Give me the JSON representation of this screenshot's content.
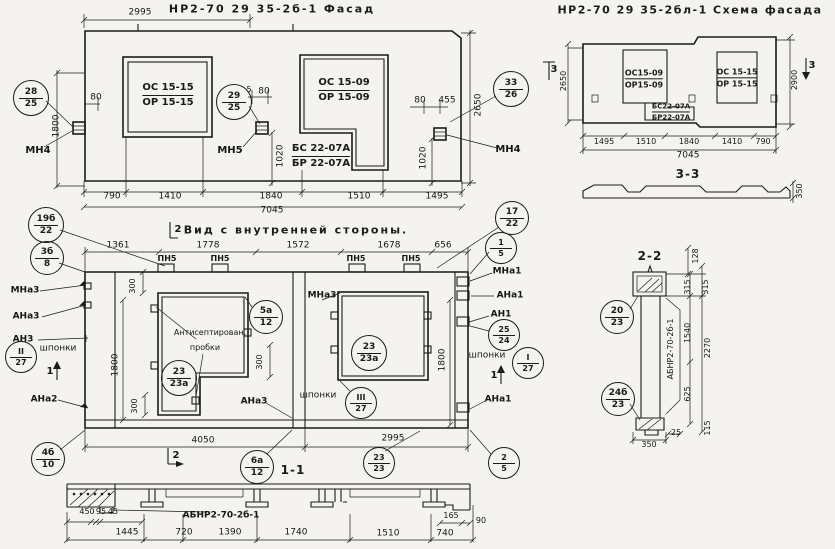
{
  "meta": {
    "paper_color": "#f4f3ef",
    "ink_color": "#1b1b1b"
  },
  "titles": {
    "facade": "НР2-70 29 35-2б-1 Фасад",
    "schema": "НР2-70 29 35-2бл-1 Схема фасада",
    "internal": "Вид с внутренней стороны.",
    "section_11": "1-1",
    "section_22": "2-2",
    "section_33": "3-3"
  },
  "fractions": [
    {
      "name": "mark-os15-15-facade",
      "top": "ОС 15-15",
      "bottom": "ОР 15-15",
      "x": 168,
      "y": 95,
      "fs": 10
    },
    {
      "name": "mark-os15-09-facade",
      "top": "ОС 15-09",
      "bottom": "ОР 15-09",
      "x": 344,
      "y": 90,
      "fs": 10
    },
    {
      "name": "mark-bs22-07a-facade",
      "top": "БС 22-07А",
      "bottom": "БР 22-07А",
      "x": 321,
      "y": 156,
      "fs": 10
    },
    {
      "name": "mark-os15-09-schema",
      "top": "ОС15-09",
      "bottom": "ОР15-09",
      "x": 644,
      "y": 79,
      "fs": 8
    },
    {
      "name": "mark-os15-15-schema",
      "top": "ОС 15-15",
      "bottom": "ОР 15-15",
      "x": 737,
      "y": 78,
      "fs": 8
    },
    {
      "name": "mark-bs22-07a-schema",
      "top": "БС22-07А",
      "bottom": "БР22-07А",
      "x": 671,
      "y": 112,
      "fs": 7
    }
  ],
  "callouts": [
    {
      "name": "callout-28-25",
      "top": "28",
      "bottom": "25",
      "x": 30,
      "y": 97,
      "r": 17
    },
    {
      "name": "callout-29-25",
      "top": "29",
      "bottom": "25",
      "x": 233,
      "y": 101,
      "r": 17
    },
    {
      "name": "callout-33-26",
      "top": "33",
      "bottom": "26",
      "x": 510,
      "y": 88,
      "r": 17
    },
    {
      "name": "callout-19b-22",
      "top": "19б",
      "bottom": "22",
      "x": 45,
      "y": 224,
      "r": 17
    },
    {
      "name": "callout-3b-8",
      "top": "3б",
      "bottom": "8",
      "x": 46,
      "y": 257,
      "r": 16
    },
    {
      "name": "callout-17-22",
      "top": "17",
      "bottom": "22",
      "x": 511,
      "y": 217,
      "r": 16
    },
    {
      "name": "callout-1-5",
      "top": "1",
      "bottom": "5",
      "x": 500,
      "y": 247,
      "r": 15
    },
    {
      "name": "callout-5a-12",
      "top": "5а",
      "bottom": "12",
      "x": 265,
      "y": 316,
      "r": 16
    },
    {
      "name": "callout-25-24",
      "top": "25",
      "bottom": "24",
      "x": 503,
      "y": 334,
      "r": 15
    },
    {
      "name": "callout-I-27",
      "top": "I",
      "bottom": "27",
      "x": 527,
      "y": 362,
      "r": 15
    },
    {
      "name": "callout-II-27",
      "top": "II",
      "bottom": "27",
      "x": 20,
      "y": 356,
      "r": 15
    },
    {
      "name": "callout-III-27",
      "top": "III",
      "bottom": "27",
      "x": 360,
      "y": 402,
      "r": 15
    },
    {
      "name": "callout-23-23a-left",
      "top": "23",
      "bottom": "23а",
      "x": 178,
      "y": 377,
      "r": 17
    },
    {
      "name": "callout-23-23a-right",
      "top": "23",
      "bottom": "23а",
      "x": 368,
      "y": 352,
      "r": 17
    },
    {
      "name": "callout-4b-10",
      "top": "4б",
      "bottom": "10",
      "x": 47,
      "y": 458,
      "r": 16
    },
    {
      "name": "callout-6a-12",
      "top": "6а",
      "bottom": "12",
      "x": 256,
      "y": 466,
      "r": 16
    },
    {
      "name": "callout-23-23",
      "top": "23",
      "bottom": "23",
      "x": 378,
      "y": 462,
      "r": 15
    },
    {
      "name": "callout-2-5",
      "top": "2",
      "bottom": "5",
      "x": 503,
      "y": 462,
      "r": 15
    },
    {
      "name": "callout-20-23",
      "top": "20",
      "bottom": "23",
      "x": 616,
      "y": 316,
      "r": 16
    },
    {
      "name": "callout-24b-23",
      "top": "24б",
      "bottom": "23",
      "x": 617,
      "y": 398,
      "r": 16
    }
  ],
  "labels": [
    {
      "name": "dim-2995-facade-top",
      "text": "2995",
      "x": 140,
      "y": 13
    },
    {
      "name": "dim-80-facade-left",
      "text": "80",
      "x": 96,
      "y": 98
    },
    {
      "name": "dim-1800-facade-left",
      "text": "1800",
      "x": 57,
      "y": 126,
      "rot": 1
    },
    {
      "name": "anchor-mn4-left",
      "text": "МН4",
      "x": 38,
      "y": 151,
      "b": 1,
      "fs": 10
    },
    {
      "name": "dim-5-facade-mid",
      "text": "5",
      "x": 249,
      "y": 90,
      "fs": 8
    },
    {
      "name": "dim-80-facade-mid",
      "text": "80",
      "x": 264,
      "y": 92
    },
    {
      "name": "anchor-mn5",
      "text": "МН5",
      "x": 230,
      "y": 151,
      "b": 1,
      "fs": 10
    },
    {
      "name": "dim-1020-facade-mid",
      "text": "1020",
      "x": 281,
      "y": 156,
      "rot": 1
    },
    {
      "name": "dim-80-facade-right",
      "text": "80",
      "x": 420,
      "y": 101
    },
    {
      "name": "dim-455-facade-right",
      "text": "455",
      "x": 447,
      "y": 101
    },
    {
      "name": "dim-1020-facade-right",
      "text": "1020",
      "x": 424,
      "y": 158,
      "rot": 1
    },
    {
      "name": "dim-2650-facade",
      "text": "2650",
      "x": 479,
      "y": 105,
      "rot": 1
    },
    {
      "name": "anchor-mn4-right",
      "text": "МН4",
      "x": 508,
      "y": 150,
      "b": 1,
      "fs": 10
    },
    {
      "name": "dim-790-facade",
      "text": "790",
      "x": 112,
      "y": 197
    },
    {
      "name": "dim-1410-facade",
      "text": "1410",
      "x": 170,
      "y": 197
    },
    {
      "name": "dim-1840-facade",
      "text": "1840",
      "x": 271,
      "y": 197
    },
    {
      "name": "dim-1510-facade",
      "text": "1510",
      "x": 359,
      "y": 197
    },
    {
      "name": "dim-1495-facade",
      "text": "1495",
      "x": 437,
      "y": 197
    },
    {
      "name": "dim-7045-facade",
      "text": "7045",
      "x": 272,
      "y": 211
    },
    {
      "name": "dim-2650-schema",
      "text": "2650",
      "x": 564,
      "y": 81,
      "rot": 1,
      "fs": 8
    },
    {
      "name": "section-mark-3-left",
      "text": "3",
      "x": 554,
      "y": 70,
      "b": 1,
      "fs": 10
    },
    {
      "name": "dim-2900-schema",
      "text": "2900",
      "x": 795,
      "y": 80,
      "rot": 1,
      "fs": 8
    },
    {
      "name": "section-mark-3-right",
      "text": "3",
      "x": 812,
      "y": 66,
      "b": 1,
      "fs": 10
    },
    {
      "name": "dim-1495-schema",
      "text": "1495",
      "x": 604,
      "y": 142,
      "fs": 8
    },
    {
      "name": "dim-1510-schema",
      "text": "1510",
      "x": 646,
      "y": 142,
      "fs": 8
    },
    {
      "name": "dim-1840-schema",
      "text": "1840",
      "x": 689,
      "y": 142,
      "fs": 8
    },
    {
      "name": "dim-1410-schema",
      "text": "1410",
      "x": 732,
      "y": 142,
      "fs": 8
    },
    {
      "name": "dim-790-schema",
      "text": "790",
      "x": 763,
      "y": 142,
      "fs": 8
    },
    {
      "name": "dim-7045-schema",
      "text": "7045",
      "x": 688,
      "y": 156
    },
    {
      "name": "dim-350-schema",
      "text": "350",
      "x": 800,
      "y": 191,
      "rot": 1,
      "fs": 8
    },
    {
      "name": "section-mark-2-top",
      "text": "2",
      "x": 178,
      "y": 230,
      "b": 1,
      "fs": 10
    },
    {
      "name": "dim-1361",
      "text": "1361",
      "x": 118,
      "y": 246
    },
    {
      "name": "dim-1778",
      "text": "1778",
      "x": 208,
      "y": 246
    },
    {
      "name": "dim-1572",
      "text": "1572",
      "x": 298,
      "y": 246
    },
    {
      "name": "dim-1678",
      "text": "1678",
      "x": 389,
      "y": 246
    },
    {
      "name": "dim-656",
      "text": "656",
      "x": 443,
      "y": 246
    },
    {
      "name": "plate-pn5-1",
      "text": "ПН5",
      "x": 167,
      "y": 259,
      "b": 1,
      "fs": 8
    },
    {
      "name": "plate-pn5-2",
      "text": "ПН5",
      "x": 220,
      "y": 259,
      "b": 1,
      "fs": 8
    },
    {
      "name": "plate-pn5-3",
      "text": "ПН5",
      "x": 356,
      "y": 259,
      "b": 1,
      "fs": 8
    },
    {
      "name": "plate-pn5-4",
      "text": "ПН5",
      "x": 411,
      "y": 259,
      "b": 1,
      "fs": 8
    },
    {
      "name": "anchor-mna3-left",
      "text": "МНа3",
      "x": 25,
      "y": 291,
      "b": 1,
      "fs": 9
    },
    {
      "name": "anchor-ana3-left",
      "text": "АНа3",
      "x": 26,
      "y": 317,
      "b": 1,
      "fs": 9
    },
    {
      "name": "anchor-an3-left",
      "text": "АН3",
      "x": 23,
      "y": 340,
      "b": 1,
      "fs": 9
    },
    {
      "name": "label-shponki-left",
      "text": "шпонки",
      "x": 58,
      "y": 349,
      "fs": 9
    },
    {
      "name": "anchor-ana2-left",
      "text": "АНа2",
      "x": 44,
      "y": 400,
      "b": 1,
      "fs": 9
    },
    {
      "name": "anchor-mna1-right",
      "text": "МНа1",
      "x": 507,
      "y": 272,
      "b": 1,
      "fs": 9
    },
    {
      "name": "anchor-ana1-right",
      "text": "АНа1",
      "x": 510,
      "y": 296,
      "b": 1,
      "fs": 9
    },
    {
      "name": "anchor-an1-right",
      "text": "АН1",
      "x": 501,
      "y": 315,
      "b": 1,
      "fs": 9
    },
    {
      "name": "label-shponki-right",
      "text": "шпонки",
      "x": 487,
      "y": 356,
      "fs": 9
    },
    {
      "name": "anchor-ana1-right-bottom",
      "text": "АНа1",
      "x": 498,
      "y": 400,
      "b": 1,
      "fs": 9
    },
    {
      "name": "anchor-mna3-inner",
      "text": "МНа3",
      "x": 322,
      "y": 296,
      "b": 1,
      "fs": 9
    },
    {
      "name": "note-antiseptic-1",
      "text": "Антисептирован.",
      "x": 210,
      "y": 333,
      "fs": 8
    },
    {
      "name": "note-antiseptic-2",
      "text": "пробки",
      "x": 205,
      "y": 348,
      "fs": 8
    },
    {
      "name": "anchor-ana3-inner",
      "text": "АНа3",
      "x": 254,
      "y": 402,
      "b": 1,
      "fs": 9
    },
    {
      "name": "label-shponki-inner",
      "text": "шпонки",
      "x": 318,
      "y": 396,
      "fs": 9
    },
    {
      "name": "dim-300-a",
      "text": "300",
      "x": 133,
      "y": 286,
      "rot": 1,
      "fs": 8
    },
    {
      "name": "dim-300-b",
      "text": "300",
      "x": 260,
      "y": 362,
      "rot": 1,
      "fs": 8
    },
    {
      "name": "dim-300-c",
      "text": "300",
      "x": 135,
      "y": 406,
      "rot": 1,
      "fs": 8
    },
    {
      "name": "dim-1800-internal-left",
      "text": "1800",
      "x": 116,
      "y": 365,
      "rot": 1
    },
    {
      "name": "dim-1800-internal-right",
      "text": "1800",
      "x": 443,
      "y": 360,
      "rot": 1
    },
    {
      "name": "section-mark-1-left",
      "text": "1",
      "x": 50,
      "y": 372,
      "b": 1,
      "fs": 10
    },
    {
      "name": "section-mark-1-right",
      "text": "1",
      "x": 494,
      "y": 376,
      "b": 1,
      "fs": 10
    },
    {
      "name": "dim-4050",
      "text": "4050",
      "x": 203,
      "y": 441
    },
    {
      "name": "dim-2995-internal",
      "text": "2995",
      "x": 393,
      "y": 439
    },
    {
      "name": "section-mark-2-bottom",
      "text": "2",
      "x": 176,
      "y": 456,
      "b": 1,
      "fs": 10
    },
    {
      "name": "dim-450",
      "text": "450",
      "x": 87,
      "y": 512,
      "fs": 8
    },
    {
      "name": "dim-95",
      "text": "95",
      "x": 101,
      "y": 512,
      "fs": 8
    },
    {
      "name": "dim-45",
      "text": "45",
      "x": 113,
      "y": 512,
      "fs": 8
    },
    {
      "name": "mark-abnr-bottom",
      "text": "АБНР2-70-2б-1",
      "x": 221,
      "y": 516,
      "b": 1,
      "fs": 9
    },
    {
      "name": "dim-165",
      "text": "165",
      "x": 451,
      "y": 516,
      "fs": 8
    },
    {
      "name": "dim-90",
      "text": "90",
      "x": 481,
      "y": 521,
      "fs": 8
    },
    {
      "name": "dim-1445",
      "text": "1445",
      "x": 127,
      "y": 533
    },
    {
      "name": "dim-720",
      "text": "720",
      "x": 184,
      "y": 533
    },
    {
      "name": "dim-1390",
      "text": "1390",
      "x": 230,
      "y": 533
    },
    {
      "name": "dim-1740",
      "text": "1740",
      "x": 296,
      "y": 533
    },
    {
      "name": "dim-1510-s11",
      "text": "1510",
      "x": 388,
      "y": 534
    },
    {
      "name": "dim-740",
      "text": "740",
      "x": 445,
      "y": 534
    },
    {
      "name": "dim-128",
      "text": "128",
      "x": 696,
      "y": 256,
      "rot": 1,
      "fs": 8
    },
    {
      "name": "dim-315-a",
      "text": "315",
      "x": 688,
      "y": 287,
      "rot": 1,
      "fs": 8
    },
    {
      "name": "dim-315-b",
      "text": "315",
      "x": 706,
      "y": 287,
      "rot": 1,
      "fs": 8
    },
    {
      "name": "dim-1540",
      "text": "1540",
      "x": 688,
      "y": 333,
      "rot": 1,
      "fs": 8
    },
    {
      "name": "dim-2270",
      "text": "2270",
      "x": 708,
      "y": 348,
      "rot": 1,
      "fs": 8
    },
    {
      "name": "mark-abnr-vertical",
      "text": "АБНР2-70-2б-1",
      "x": 671,
      "y": 349,
      "rot": 1,
      "fs": 8
    },
    {
      "name": "dim-625",
      "text": "625",
      "x": 688,
      "y": 394,
      "rot": 1,
      "fs": 8
    },
    {
      "name": "dim-115",
      "text": "115",
      "x": 708,
      "y": 428,
      "rot": 1,
      "fs": 8
    },
    {
      "name": "dim-25",
      "text": "25",
      "x": 676,
      "y": 433,
      "fs": 8
    },
    {
      "name": "dim-350-s22",
      "text": "350",
      "x": 649,
      "y": 445,
      "fs": 8
    }
  ]
}
